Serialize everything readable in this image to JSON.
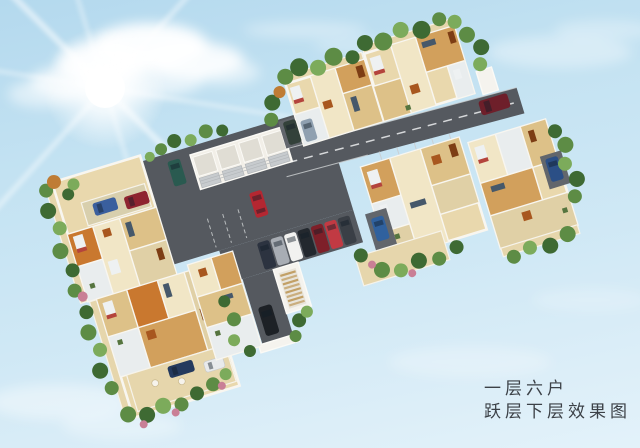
{
  "image_type": "residential floor-plan 3D rendering (bird's-eye cutaway)",
  "caption": {
    "line1": "一层六户",
    "line2": "跃层下层效果图"
  },
  "scene": {
    "sky": {
      "top_color": "#b4d9ee",
      "bottom_color": "#e3f2fa",
      "sun": "sunburst upper-left with diagonal lens-flare rays",
      "clouds": "white cumulus near sun, faint wisps top-right and bottom-left"
    },
    "site": {
      "units_per_floor": 6,
      "building_layout": "zigzag slab of six cutaway apartment units around a diagonal road and central parking lot",
      "garage_bays": 4,
      "stairwells": 2,
      "road": {
        "color": "#55595f",
        "markings": "white dashed centerline and parking stall lines"
      },
      "floor_color": "#e9d8ad",
      "wall_color": "#f8f6f0",
      "greenery_colors": [
        "#3e6a33",
        "#5d8c45",
        "#7cab5b"
      ],
      "flower_color": "#c97f96"
    },
    "vehicles": [
      {
        "type": "hatchback",
        "color": "teal",
        "location": "left of garages"
      },
      {
        "type": "sedan",
        "color": "red",
        "location": "driving in parking lot"
      },
      {
        "type": "suv",
        "color": "dark green",
        "location": "driveway right of garages"
      },
      {
        "type": "sedan",
        "color": "gray blue",
        "location": "driveway right of garages"
      },
      {
        "type": "parked row",
        "colors": [
          "navy",
          "silver",
          "white",
          "black",
          "maroon",
          "red",
          "graphite"
        ],
        "location": "stalls at lot edge"
      },
      {
        "type": "sedan",
        "color": "black",
        "location": "branch road by stairwell"
      },
      {
        "type": "suv",
        "color": "maroon",
        "location": "road end upper right"
      },
      {
        "type": "sedan",
        "color": "blue",
        "location": "pad at right unit"
      },
      {
        "type": "sedan",
        "color": "blue",
        "location": "pad at lower-right unit"
      },
      {
        "type": "sedans",
        "colors": [
          "blue",
          "dark red"
        ],
        "location": "strip on left unit"
      },
      {
        "type": "sedans",
        "colors": [
          "navy",
          "white"
        ],
        "location": "garden of bottom unit"
      }
    ],
    "caption_text_color": "#3c4147"
  }
}
